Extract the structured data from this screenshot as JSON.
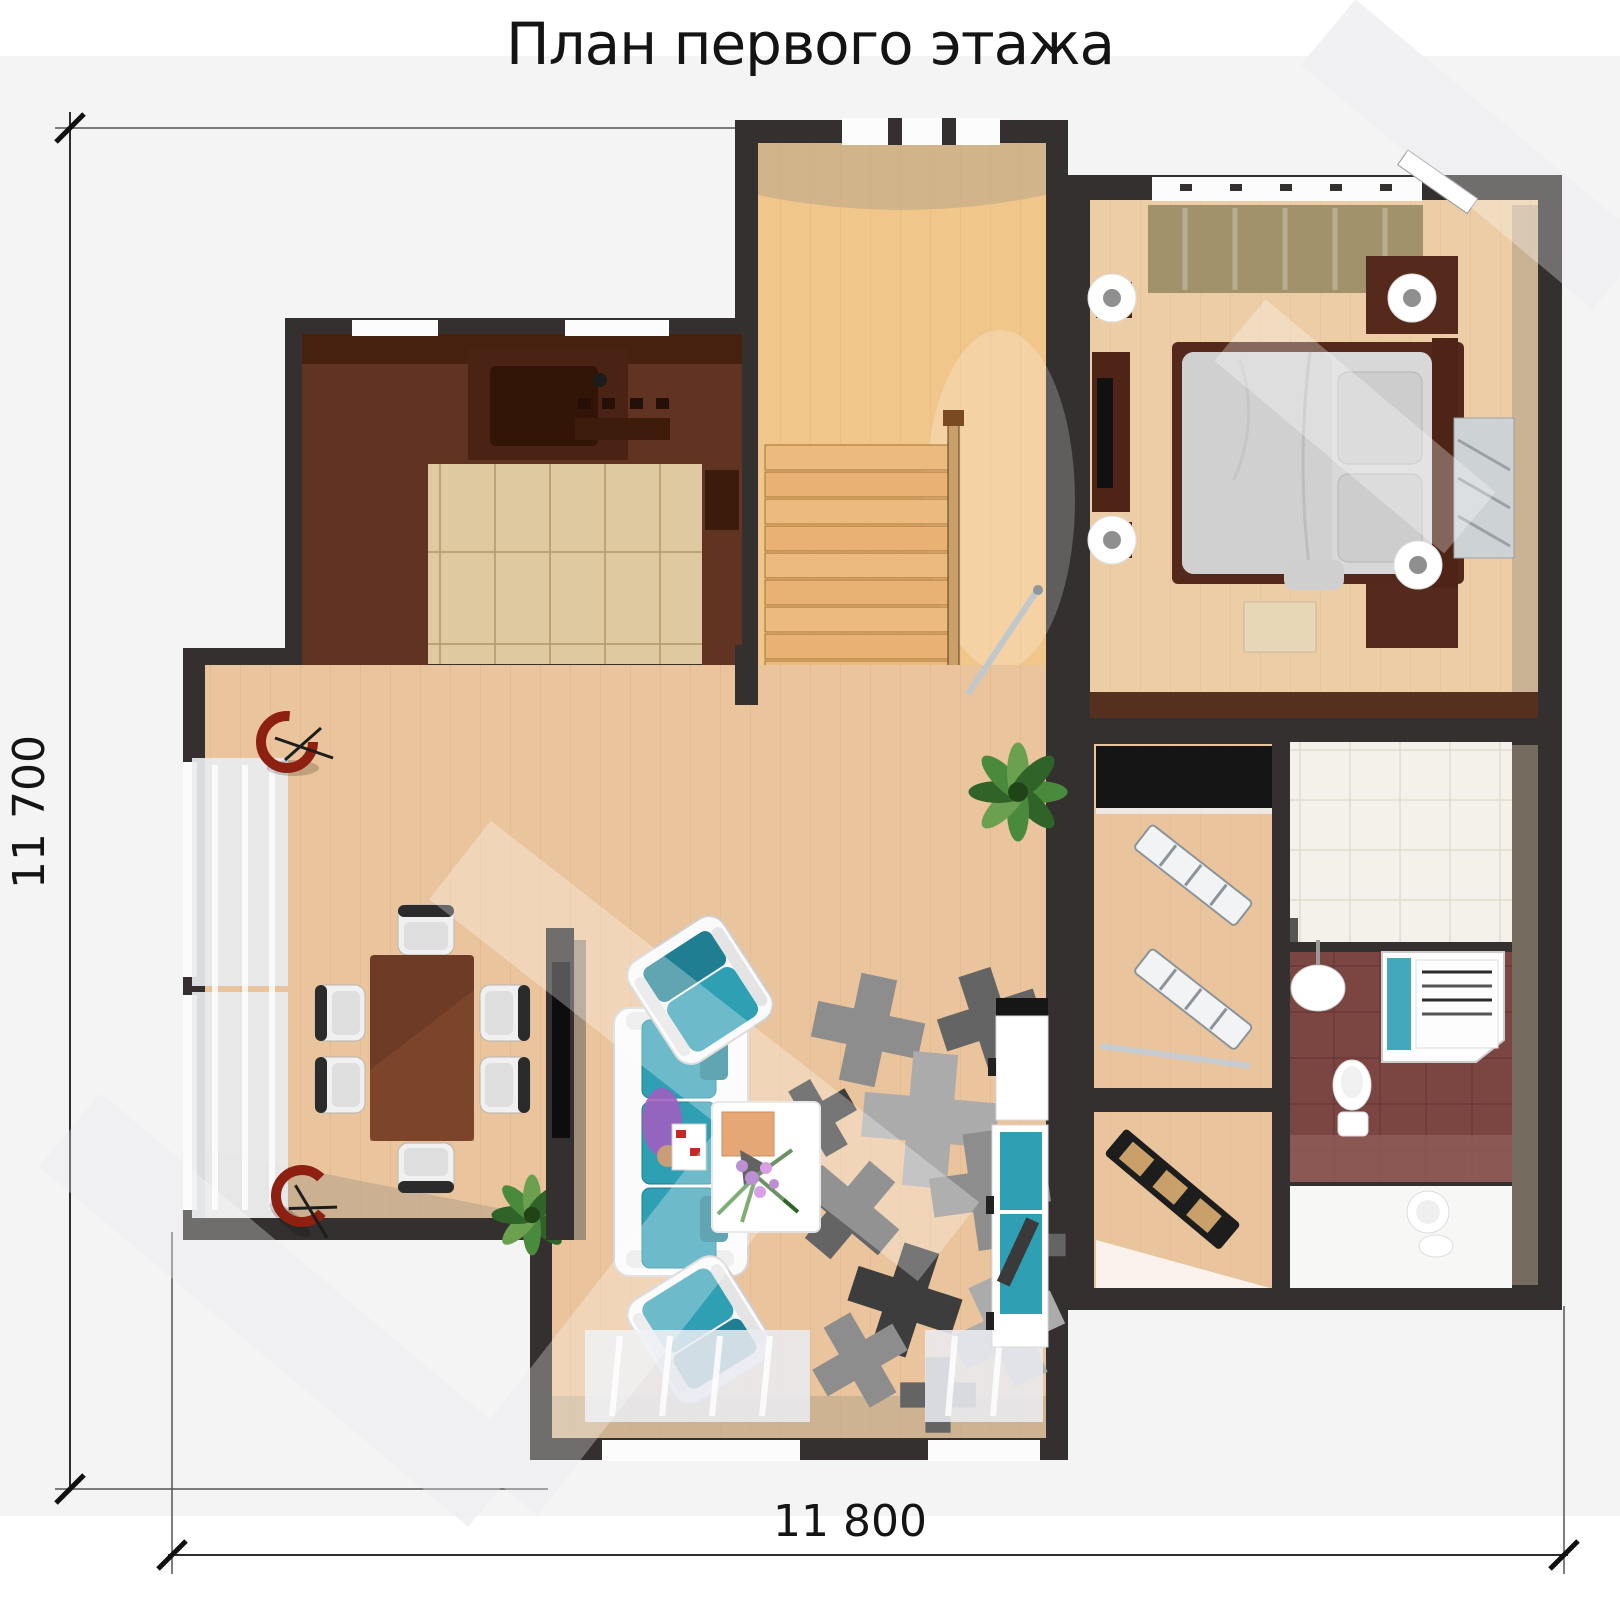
{
  "title": "План первого этажа",
  "dimensions": {
    "height": "11 700",
    "width": "11 800"
  },
  "colors": {
    "bg": "#f4f4f5",
    "paper": "#ffffff",
    "ink": "#141414",
    "dim": "#2e2e2e",
    "wall": "#343030",
    "wood": "#eac49c",
    "woodlight": "#f1c68b",
    "woodbed": "#edcda6",
    "tile": "#dec9a1",
    "cab": "#603323",
    "cabdark": "#46210f",
    "teal": "#2f9fb4",
    "tealdark": "#1f7e92",
    "offwhite": "#f3f1ea",
    "maroon": "#7b4541",
    "maroonlight": "#8d5a55",
    "rug1": "#ababab",
    "rug2": "#8d8d8d",
    "rug3": "#646464",
    "rug4": "#3d3d3d",
    "olive": "#998c66",
    "bedgray": "#d8d8d8",
    "curtain": "#e9ebf0",
    "red": "#8e2012",
    "green": "#4a8a3c",
    "greendark": "#2f6327",
    "beige": "#b6a58b",
    "bench": "#e7d7b6",
    "table": "#6e3b26",
    "purple": "#a05ec0",
    "skin": "#c99d76",
    "wm": "#e9e9ee"
  }
}
